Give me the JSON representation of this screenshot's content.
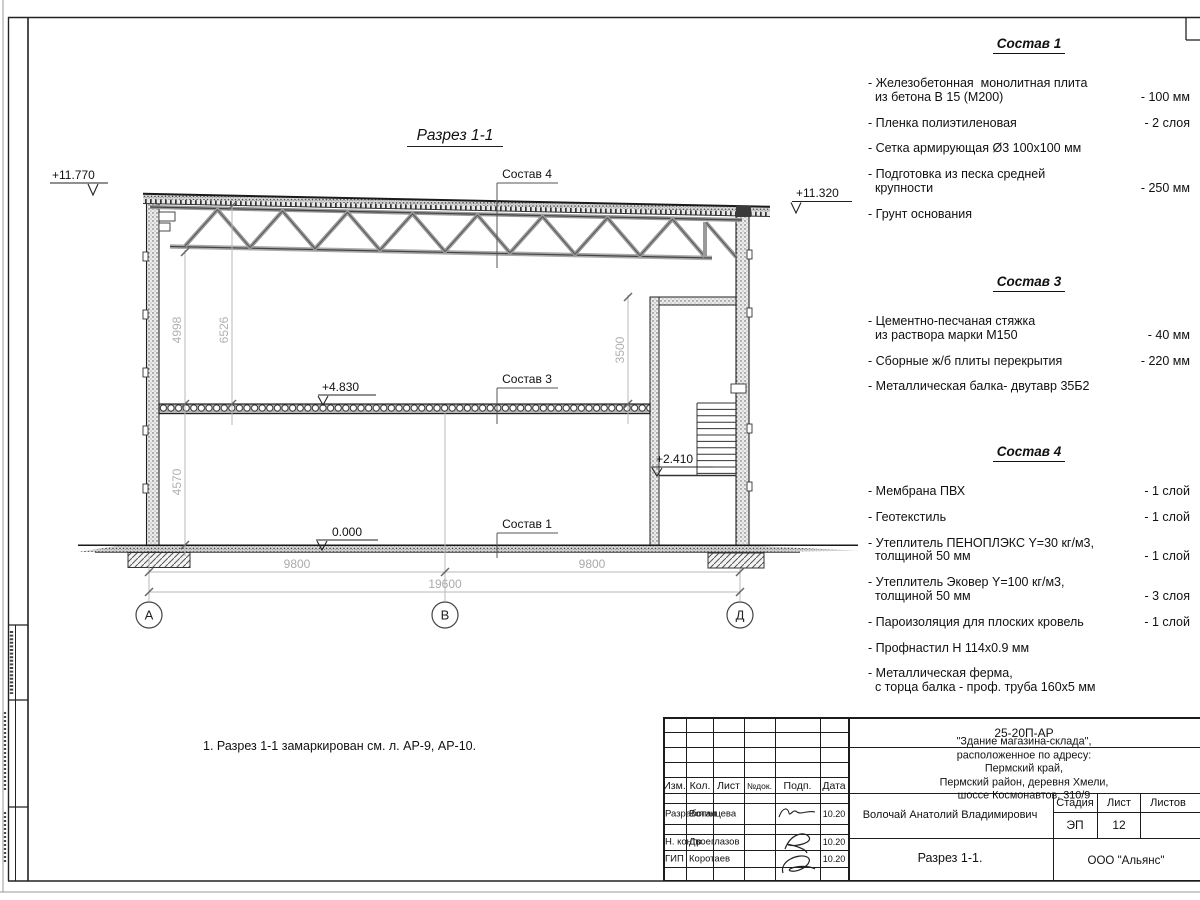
{
  "drawing": {
    "section_title": "Разрез 1-1",
    "note": "1. Разрез 1-1 замаркирован см. л. АР-9, АР-10.",
    "elevations": {
      "roof_left": "+11.770",
      "roof_right": "+11.320",
      "floor_slab": "+4.830",
      "ground": "0.000",
      "stair_landing": "+2.410"
    },
    "leaders": {
      "sostav4": "Состав 4",
      "sostav3": "Состав 3",
      "sostav1": "Состав 1"
    },
    "dims": {
      "d4998": "4998",
      "d6526": "6526",
      "d3500": "3500",
      "d4570": "4570",
      "span1": "9800",
      "span2": "9800",
      "total": "19600"
    },
    "axes": [
      "А",
      "В",
      "Д"
    ]
  },
  "specs": [
    {
      "title": "Состав 1",
      "items": [
        {
          "name": "- Железобетонная  монолитная плита\n  из бетона В 15 (М200)",
          "value": "- 100 мм"
        },
        {
          "name": "- Пленка полиэтиленовая",
          "value": "-  2 слоя"
        },
        {
          "name": "- Сетка армирующая Ø3 100х100 мм",
          "value": ""
        },
        {
          "name": "- Подготовка из песка средней\n  крупности",
          "value": "- 250 мм"
        },
        {
          "name": "- Грунт основания",
          "value": ""
        }
      ]
    },
    {
      "title": "Состав 3",
      "items": [
        {
          "name": "- Цементно-песчаная стяжка\n  из раствора марки М150",
          "value": "- 40 мм"
        },
        {
          "name": "- Сборные ж/б плиты перекрытия",
          "value": "- 220 мм"
        },
        {
          "name": "- Металлическая балка- двутавр 35Б2",
          "value": ""
        }
      ]
    },
    {
      "title": "Состав 4",
      "items": [
        {
          "name": "- Мембрана ПВХ",
          "value": "- 1 слой"
        },
        {
          "name": "- Геотекстиль",
          "value": "- 1 слой"
        },
        {
          "name": "- Утеплитель ПЕНОПЛЭКС Y=30 кг/м3,\n  толщиной 50 мм",
          "value": "- 1 слой"
        },
        {
          "name": "- Утеплитель Эковер Y=100 кг/м3,\n  толщиной 50 мм",
          "value": "- 3 слоя"
        },
        {
          "name": "- Пароизоляция для плоских кровель",
          "value": "- 1 слой"
        },
        {
          "name": "- Профнастил Н 114х0.9 мм",
          "value": ""
        },
        {
          "name": "- Металлическая ферма,\n  с торца балка - проф. труба 160х5 мм",
          "value": ""
        }
      ]
    }
  ],
  "titleblock": {
    "doc_number": "25-20П-АР",
    "project": "\"Здание магазина-склада\", расположенное по адресу: Пермский край,\nПермский район, деревня Хмели, шоссе Космонавтов, 310/9",
    "cols": [
      "Изм.",
      "Кол.",
      "Лист",
      "№док.",
      "Подп.",
      "Дата"
    ],
    "rows": [
      {
        "role": "Разработал",
        "name": "Вотинцева",
        "date": "10.20"
      },
      {
        "role": "Н. контр.",
        "name": "Двоеглазов",
        "date": "10.20"
      },
      {
        "role": "ГИП",
        "name": "Коротаев",
        "date": "10.20"
      }
    ],
    "designer_full": "Волочай Анатолий Владимирович",
    "stage_label": "Стадия",
    "sheet_label": "Лист",
    "sheets_label": "Листов",
    "stage": "ЭП",
    "sheet": "12",
    "sheets": "",
    "sheet_title": "Разрез 1-1.",
    "company": "ООО \"Альянс\""
  }
}
